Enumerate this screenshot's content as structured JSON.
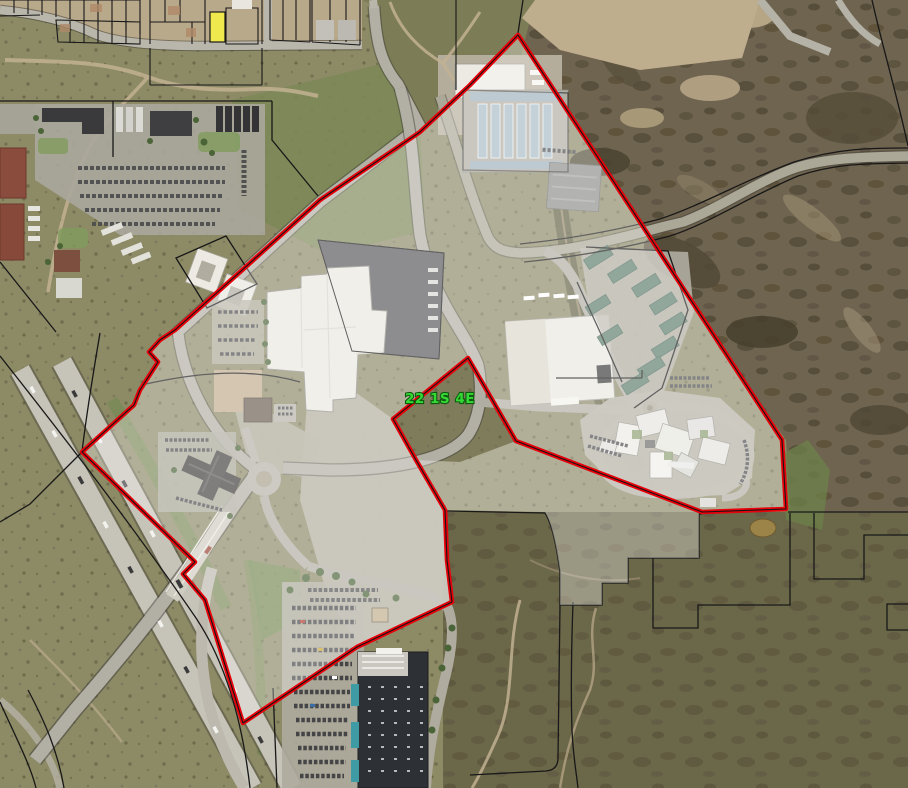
{
  "map": {
    "view": "aerial-satellite-parcel-viewer",
    "section_label": "22 1S 4E",
    "colors": {
      "selection_boundary": "#e8000a",
      "boundary_centerline": "#141414",
      "parcel_line": "#181818",
      "selection_fill": "rgba(255,255,255,0.32)",
      "section_label_fill": "#35d936",
      "section_label_outline": "#0f5a0f",
      "highlighted_lot_fill": "#efe94e",
      "highway_pavement": "#c6c3b9",
      "road_pavement": "#b2afa4",
      "big_box_roof": "#2d3034",
      "big_box_accent_teal": "#3e9aa3",
      "water_pond": "#9c8348"
    }
  }
}
